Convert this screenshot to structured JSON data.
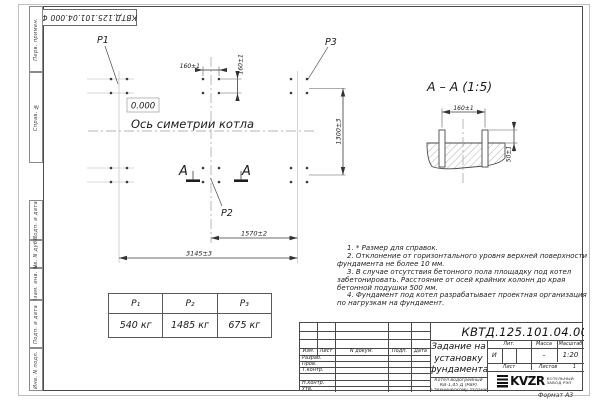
{
  "stamp_top": "КВТД.125.101.04.000  Ф",
  "margin": {
    "col1": "Перв. примен.",
    "col2": "Справ. №",
    "col3": "Подп. и дата",
    "col4": "Инв. N дубл.",
    "col5": "Взам. инв. N",
    "col6": "Подп. и дата",
    "col7": "Инв. N подл."
  },
  "plan": {
    "p1": "P1",
    "p2": "P2",
    "p3": "P3",
    "elevation": "0.000",
    "axis_label": "Ось симетрии котла",
    "section_letter": "A",
    "dim_160h": "160±1",
    "dim_160v": "160±1",
    "dim_1570": "1570±2",
    "dim_3145": "3145±3",
    "dim_1300": "1300±3"
  },
  "section": {
    "title": "A – A (1:5)",
    "dim_160": "160±1",
    "dim_50": "50±1"
  },
  "notes": {
    "line1": "1. * Размер для справок.",
    "line2": "2. Отклонение от горизонтального уровня верхней поверхности фундамента не более 10 мм.",
    "line3": "3. В случае отсутствия бетонного пола площадку под котел забетонировать. Расстояние от осей крайних колонн до края бетонной подушки 500 мм.",
    "line4": "4. Фундамент под котел разрабатывает проектная организация по нагрузкам на фундамент."
  },
  "load_table": {
    "headers": [
      "P₁",
      "P₂",
      "P₃"
    ],
    "values": [
      "540 кг",
      "1485 кг",
      "675 кг"
    ]
  },
  "title_block": {
    "doc_number": "КВТД.125.101.04.000  Ф",
    "title_line1": "Задание на",
    "title_line2": "установку",
    "title_line3": "фундамента",
    "header_izm": "Изм.",
    "header_list": "Лист",
    "header_doc": "N докум.",
    "header_podp": "Подп.",
    "header_data": "Дата",
    "row_razrab": "Разраб.",
    "row_prov": "Пров.",
    "row_tkontr": "Т.контр.",
    "row_nkontr": "Н.контр.",
    "row_utv": "Утв.",
    "lit_label": "Лит.",
    "massa_label": "Масса",
    "masshtab_label": "Масштаб",
    "lit_value": "И",
    "massa_value": "–",
    "masshtab_value": "1:20",
    "list_label": "Лист",
    "listov_label": "Листов",
    "listov_value": "1",
    "product_line1": "Котел водогрейный",
    "product_line2": "КВ-1,45 Д (РВР)",
    "product_line3": "по техническому заданию",
    "logo_text": "KVZR",
    "company_line1": "КОТЕЛЬНЫЙ",
    "company_line2": "ЗАВОД РЭП",
    "format_label": "Формат А3"
  }
}
